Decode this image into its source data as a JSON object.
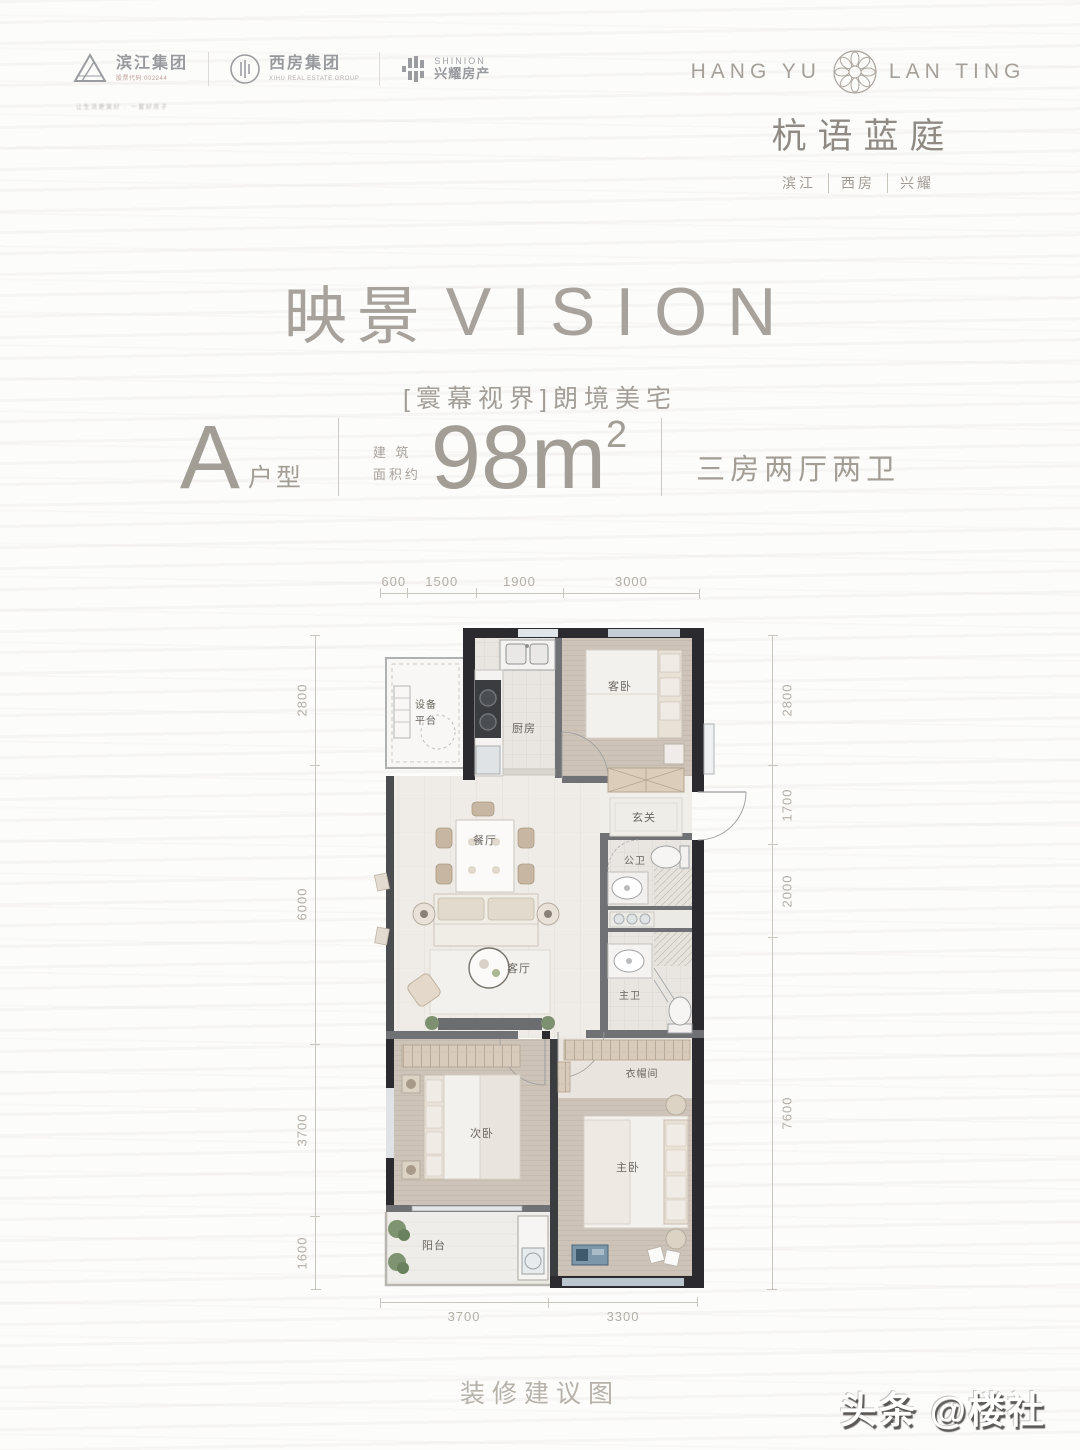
{
  "page": {
    "caption": "装修建议图",
    "watermark": "头条 @楼社"
  },
  "logos": {
    "binjiang": {
      "name": "滨江集团",
      "sub": "股票代码:002244",
      "tagline": "让生活更美好 · 一套好房子"
    },
    "xifang": {
      "name": "西房集团",
      "sub": "XIHU REAL ESTATE GROUP"
    },
    "shinion": {
      "name": "SHINION",
      "sub": "兴耀房产"
    }
  },
  "brand": {
    "latin_left": "HANG YU",
    "latin_right": "LAN TING",
    "cn": "杭语蓝庭",
    "sub": [
      "滨江",
      "西房",
      "兴耀"
    ]
  },
  "hero": {
    "title_cn": "映景",
    "title_en": "VISION",
    "subtitle": "[寰幕视界]朗境美宅"
  },
  "spec": {
    "type_letter": "A",
    "type_label": "户型",
    "area_label_1": "建 筑",
    "area_label_2": "面积约",
    "area_value": "98m",
    "area_sup": "2",
    "layout": "三房两厅两卫"
  },
  "dimensions": {
    "top": [
      "600",
      "1500",
      "1900",
      "3000"
    ],
    "left": [
      "2800",
      "6000",
      "3700",
      "1600"
    ],
    "right": [
      "2800",
      "1700",
      "2000",
      "7600"
    ],
    "bottom": [
      "3700",
      "3300"
    ]
  },
  "rooms": {
    "equipment_1": "设备",
    "equipment_2": "平台",
    "kitchen": "厨房",
    "guest_bedroom": "客卧",
    "entry": "玄关",
    "dining": "餐厅",
    "public_bath": "公卫",
    "living": "客厅",
    "master_bath": "主卫",
    "second_bedroom": "次卧",
    "closet": "衣帽间",
    "master_bedroom": "主卧",
    "balcony": "阳台"
  },
  "colors": {
    "accent_text": "#a7a19a",
    "dim_text": "#b3aea6",
    "wall_dark": "#2b2b2f",
    "wall_gray": "#6f7175",
    "carpet": "#cdc3b8",
    "window_blue": "#b9c6cd"
  }
}
